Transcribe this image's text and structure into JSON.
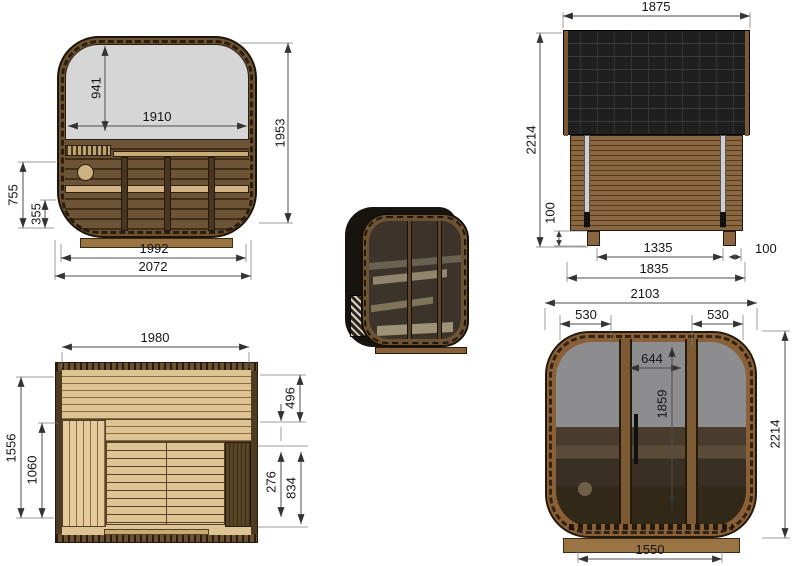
{
  "drawing": {
    "views": {
      "side": {
        "dims": {
          "window_inner_height": "941",
          "window_width": "1910",
          "body_height": "1953",
          "bench_back_height": "755",
          "bench_seat_height": "355",
          "floor_width": "1992",
          "overall_width": "2072"
        }
      },
      "rear": {
        "dims": {
          "roof_width": "1875",
          "overall_height": "2214",
          "skid_height": "100",
          "skid_spacing": "1335",
          "skid_offset": "100",
          "base_width": "1835"
        }
      },
      "plan": {
        "dims": {
          "inner_width": "1980",
          "inner_depth": "1556",
          "walkway_depth": "1060",
          "bench_depth": "496",
          "heater_zone_width": "276",
          "floor_zone_depth": "834"
        }
      },
      "front": {
        "dims": {
          "overall_width": "2103",
          "left_panel_width": "530",
          "right_panel_width": "530",
          "door_width": "644",
          "door_height": "1859",
          "overall_height": "2214",
          "base_width": "1550"
        }
      }
    },
    "colors": {
      "background": "#ffffff",
      "dim_line": "#4d4d4d",
      "dim_text": "#141414",
      "wood_frame": "#8a6038",
      "wood_wall_dark": "#6d5436",
      "wood_bench_light": "#d3b585",
      "roof_shingle": "#1f1f1f",
      "window_glass": "#d6d6d6",
      "front_glass_top": "#8d8d8f",
      "front_glass_bottom": "#322818"
    }
  }
}
